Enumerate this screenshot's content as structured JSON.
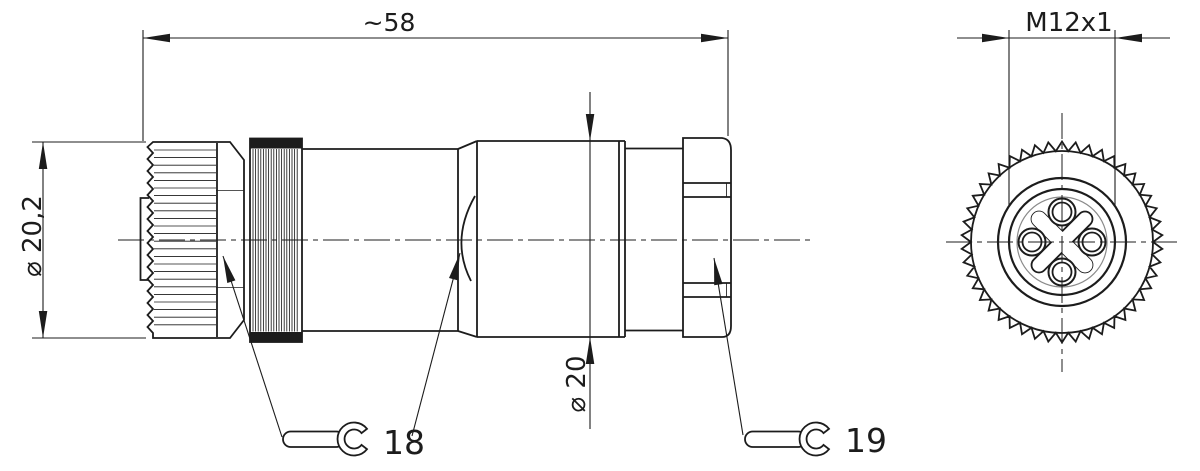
{
  "drawing": {
    "dimensions": {
      "overall_length": "~58",
      "front_diameter": "⌀ 20,2",
      "body_diameter": "⌀ 20",
      "thread_size": "M12x1"
    },
    "wrenches": {
      "front_size": "18",
      "back_size": "19"
    },
    "icons": {
      "wrench_front": "open-end-wrench-icon",
      "wrench_back": "open-end-wrench-icon"
    },
    "colors": {
      "line": "#1c1c1c",
      "thin_detail": "#8a8a8a",
      "background": "#ffffff"
    }
  }
}
